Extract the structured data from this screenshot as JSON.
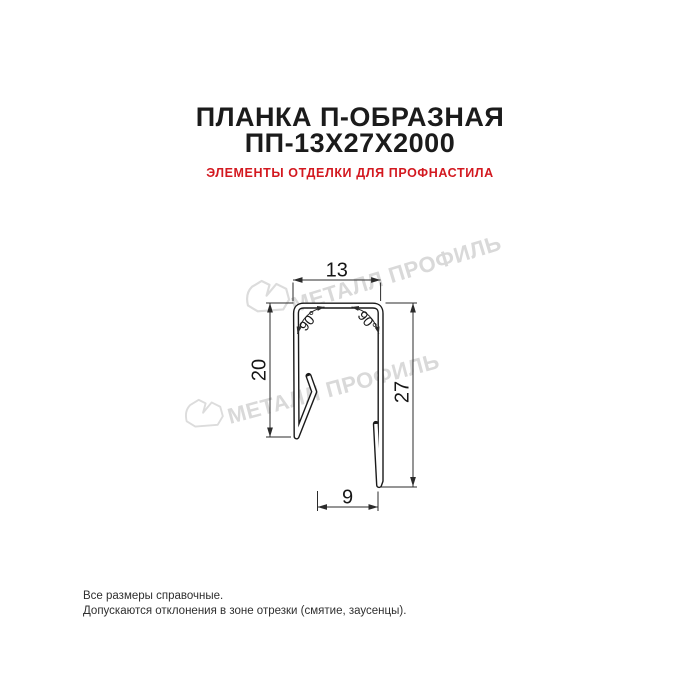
{
  "header": {
    "title_line1": "ПЛАНКА П-ОБРАЗНАЯ",
    "title_line2": "ПП-13Х27Х2000",
    "subtitle": "ЭЛЕМЕНТЫ ОТДЕЛКИ ДЛЯ ПРОФНАСТИЛА"
  },
  "drawing": {
    "type": "technical-cross-section",
    "dimensions": {
      "top_width": "13",
      "left_height": "20",
      "right_height": "27",
      "bottom_width": "9",
      "angle_left": "90°",
      "angle_right": "90°"
    }
  },
  "watermark": {
    "text": "МЕТАЛЛ ПРОФИЛЬ"
  },
  "footer": {
    "line1": "Все размеры справочные.",
    "line2": "Допускаются отклонения в зоне отрезки (смятие, заусенцы)."
  },
  "colors": {
    "title": "#1b1b1b",
    "subtitle_accent": "#d31920",
    "drawing_line": "#1a1a1a",
    "dimension_line": "#2b2b2b",
    "watermark": "#d9d9d9",
    "background": "#ffffff"
  }
}
